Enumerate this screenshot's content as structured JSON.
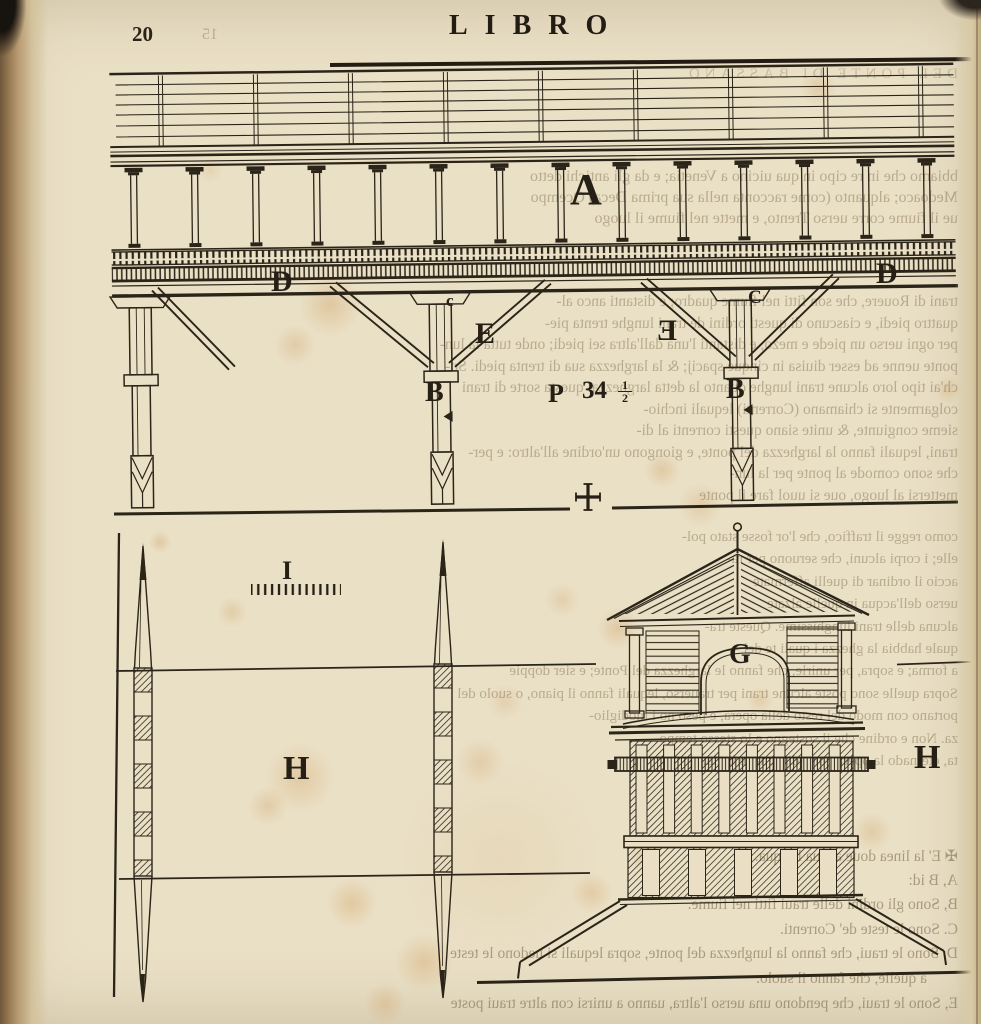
{
  "page": {
    "number": "20",
    "header": "LIBRO"
  },
  "plate": {
    "labels": {
      "a": "A",
      "d_left": "D",
      "d_right": "D",
      "c_small": "c",
      "c_right": "C",
      "e_left": "E",
      "e_mirrored": "E",
      "b_center": "B",
      "b_right": "B",
      "p": "P",
      "measure": "34",
      "fraction_numerator": "1",
      "fraction_denominator": "2",
      "i": "I",
      "h_left": "H",
      "h_right": "H",
      "g": "G"
    }
  },
  "bleedthrough": {
    "verso_page_number": "15",
    "running_head": "DEL PONTE DI BASSANO",
    "paragraph_top": [
      "bbiamo che in re cipo in qua uicino a Venetia; e da gli antichi detto",
      "Medoaco; alquanto (come racconta nella sua prima Deca) Ocempo",
      "ue il fiume corre uerso Trento, e mette nel fiume il luogo"
    ],
    "paragraph_middle": [
      "trani di Rouere, che son fitti nel fiume quadro; e distanti anco al-",
      "quattro piedi, e ciascuno di questi ordini de trani lunghe trenta pie-",
      "per ogni uerso un piede e mezo, e distanti l'una dall'altra sei piedi; onde tutta la lun-",
      "ponte uenne ad esser diuisa in cinque spacij; & la larghezza sua di trenta piedi. So-",
      "ch'ai tipo loro alcune trani lunghe quanto la detta larghezza: questa sorte di trani",
      "colgarmente si chiamano (Correnti) lequali inchio-",
      "sieme congiunte, & unite siano questi correnti al di-",
      "trani, lequali fanno la larghezza del ponte, e giongono un'ordine all'altro: e per-",
      "che sono comode al ponte per la lun-",
      "mettersi al luogo, oue si uuol fare il ponte"
    ],
    "paragraph_right": [
      "como regge il traffico, che l'or fosse stato pol-",
      "elle; i corpi alcuni, che seruono per ra-",
      "accio il ordinar di quelli affermate",
      "uerso dell'acqua in quelle alzate",
      "alcuna delle trani lunghissime. Queste tra-",
      "quale habbia la ghezza i quali te del",
      "a forma; e sopra, per unirle, che fanno le larghezza del Ponte; e sier doppie",
      "Sopra quelle sono poste alcune trani per trauerso, lequali fanno il piano, o suolo del",
      "portano con modo del resto della opera, e peso no i modiglio-",
      "za. Non e ordine che il sostegno e lo stesso tempo-",
      "ta, eternado la opera comodissima, e bella."
    ],
    "legend": [
      "✠  E' la linea doue arriua l'acqua.",
      "A,  B id:",
      "B,  Sono gli ordini delle traui fitti nel fiume.",
      "C.  Sono le teste de' Correnti.",
      "D,  Sono le traui, che fanno la lunghezza del ponte, sopra lequali si uedono le teste",
      "  a quelle, che fanno il suolo.",
      "E,  Sono le traui, che pendono una uerso l'altra, uanno a unirsi con altre traui poste"
    ]
  },
  "colors": {
    "paper": "#eae0c6",
    "ink": "#2b2418",
    "stain": "#c18230",
    "binding": "#8a6d4a",
    "bleed_text": "#7a6646"
  }
}
